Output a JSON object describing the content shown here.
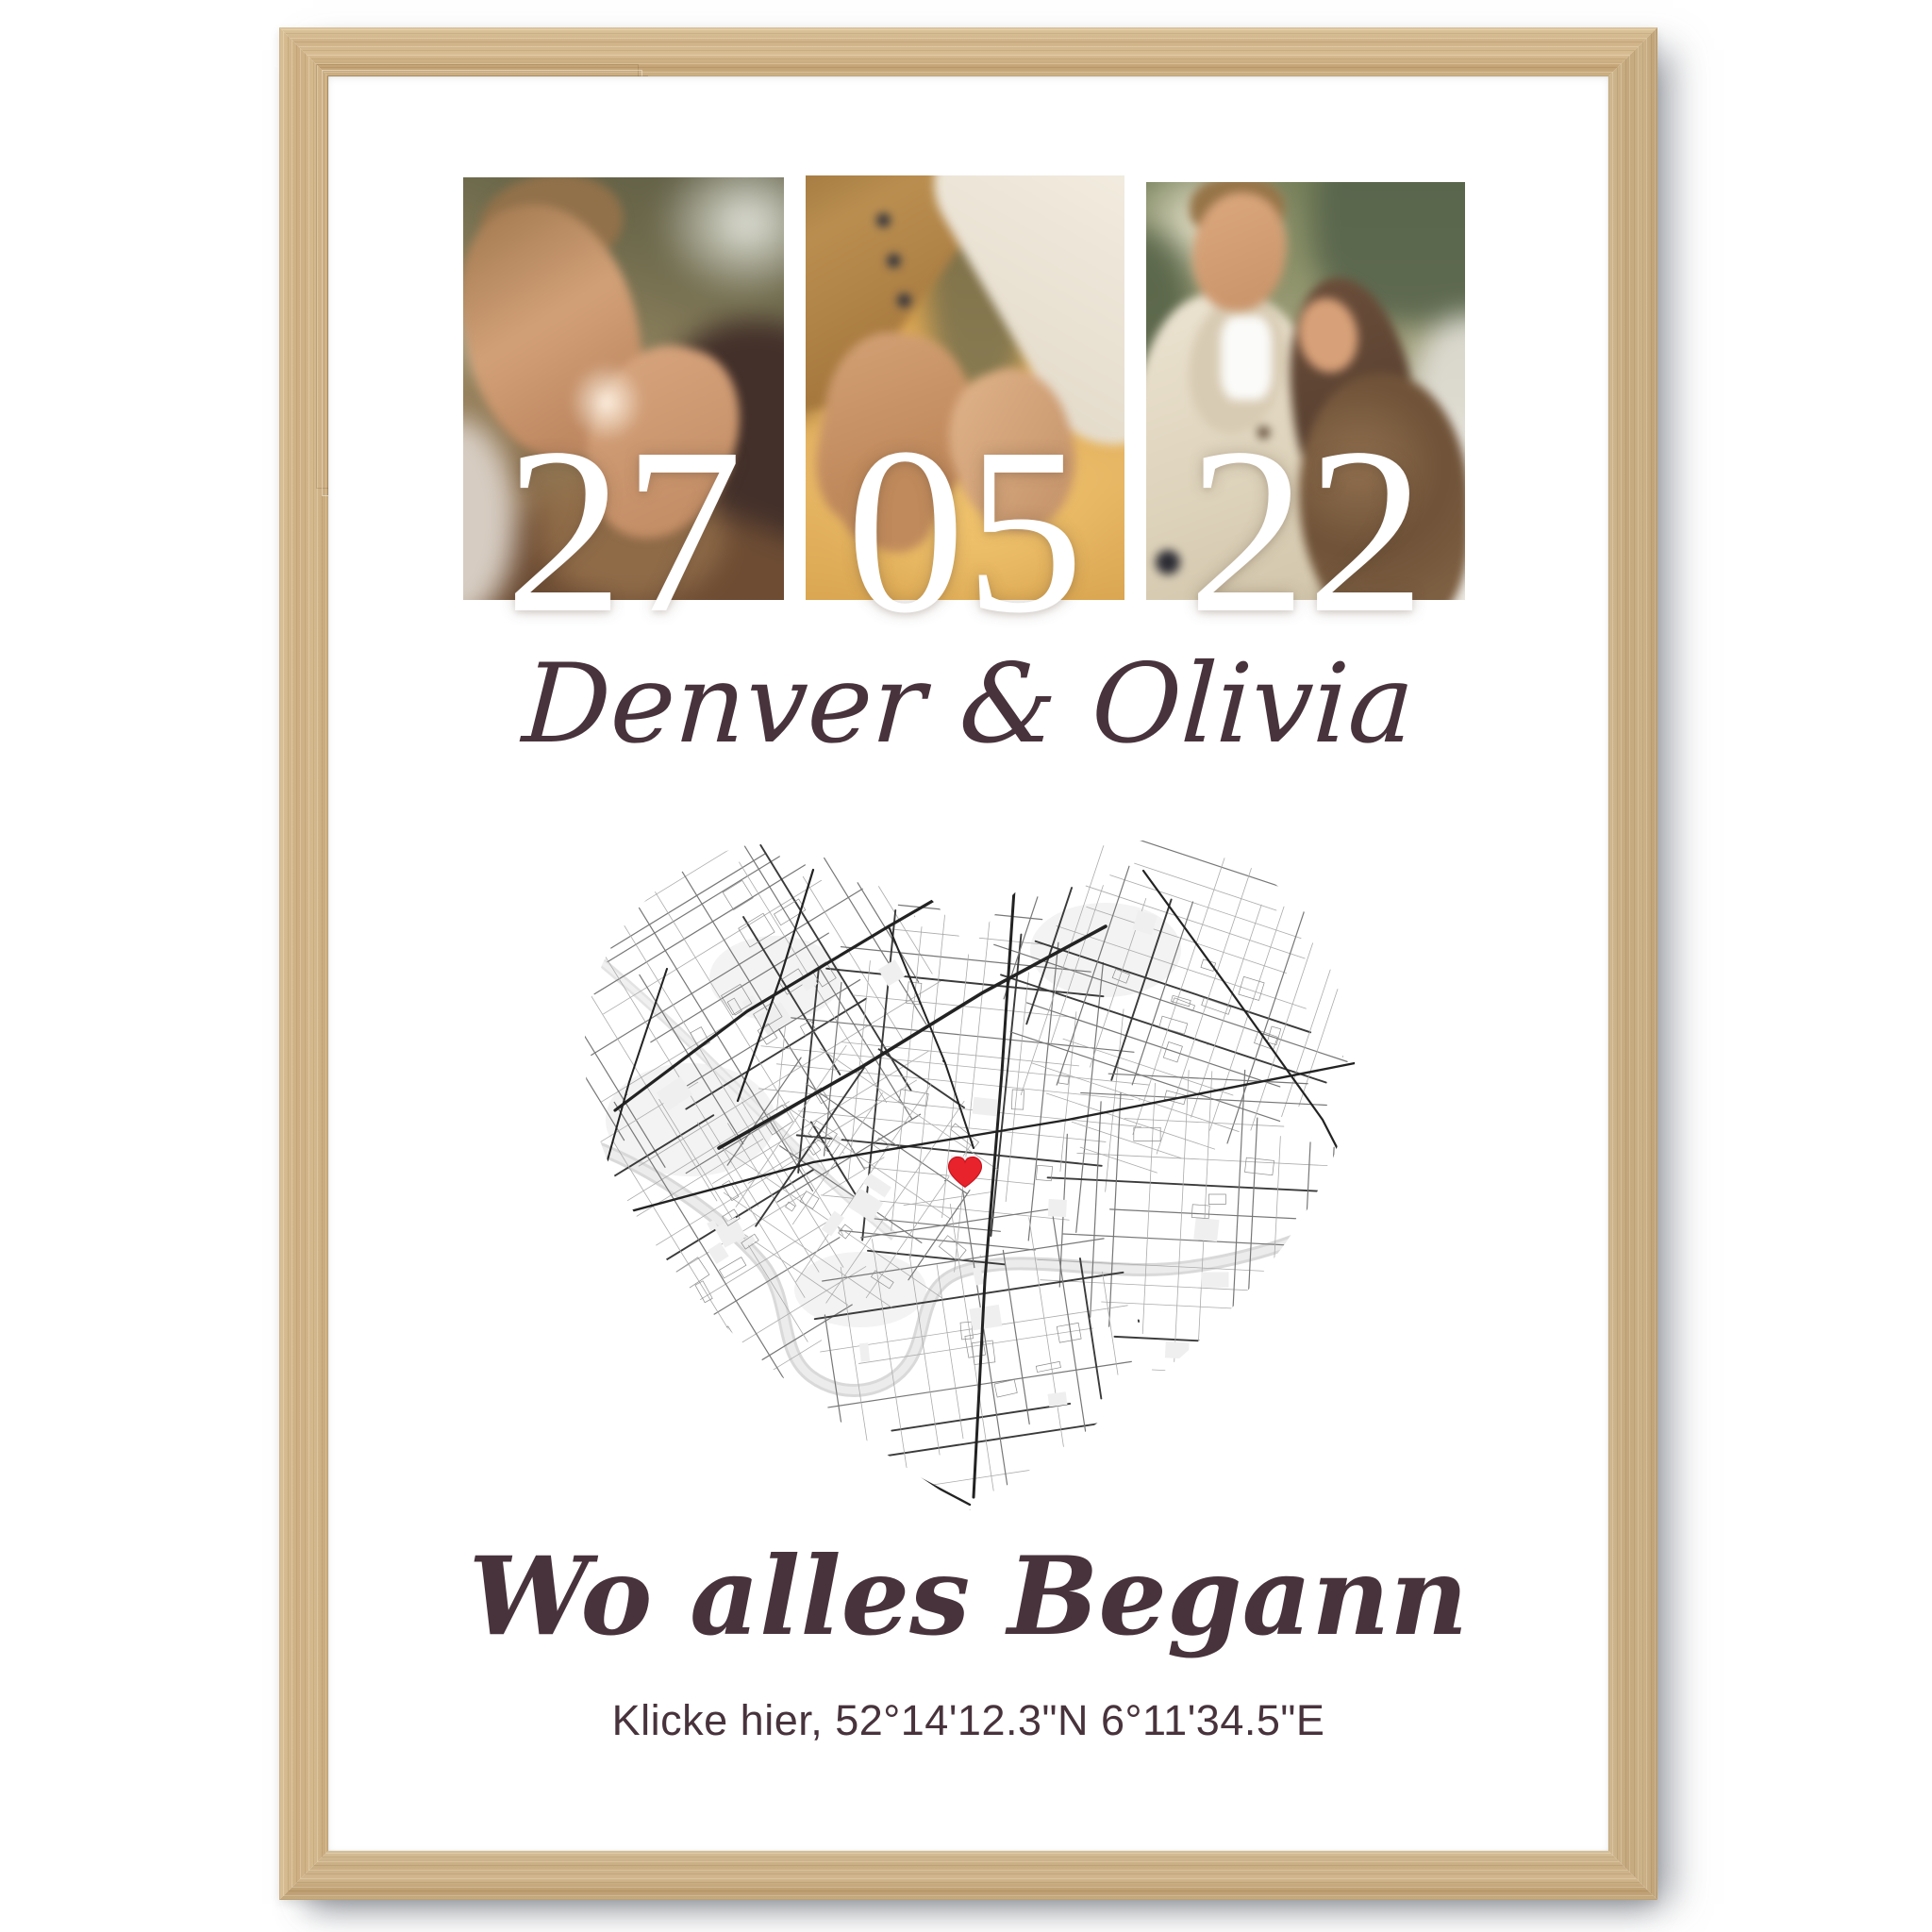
{
  "product": {
    "type": "framed poster mockup",
    "frame_material_color": "#ccb083",
    "background_color": "#ffffff"
  },
  "poster": {
    "date": {
      "day": "27",
      "month": "05",
      "year": "22"
    },
    "couple_names": "Denver & Olivia",
    "headline": "Wo alles Begann",
    "coordinates_line": "Klicke hier, 52°14'12.3\"N 6°11'34.5\"E",
    "photos": [
      {
        "alt": "couple kissing close-up outdoors"
      },
      {
        "alt": "hands pinky-holding, camel coat sleeve and white sleeve, golden background"
      },
      {
        "alt": "couple embracing outdoors, man in cream cardigan, woman in brown fur coat"
      }
    ],
    "map": {
      "shape": "heart",
      "style": "black and white street map",
      "marker": {
        "symbol": "heart",
        "color": "#e8232b",
        "x": 0.494,
        "y": 0.489
      }
    },
    "colors": {
      "text": "#48333c",
      "digits": "#ffffff",
      "map_major_road": "#222222",
      "map_minor_road": "#ababab",
      "map_water": "#dcdcdc"
    }
  }
}
